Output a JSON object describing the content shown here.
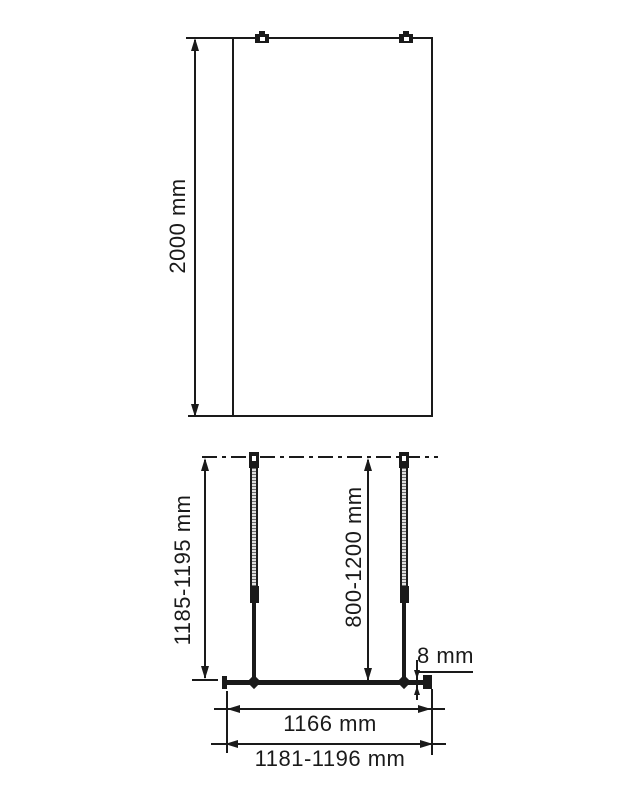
{
  "drawing": {
    "type": "shower-walk-in-screen-technical-drawing",
    "colors": {
      "line": "#1a1a1a",
      "background": "#ffffff",
      "tube_hatch_dark": "#6e6e6e",
      "tube_hatch_light": "#e0e0e0"
    },
    "front_view": {
      "height_label": "2000 mm"
    },
    "plan_view": {
      "install_height_label": "1185-1195 mm",
      "support_bar_length_label": "800-1200 mm",
      "glass_thickness_label": "8 mm",
      "glass_width_label": "1166 mm",
      "total_width_label": "1181-1196 mm"
    }
  }
}
